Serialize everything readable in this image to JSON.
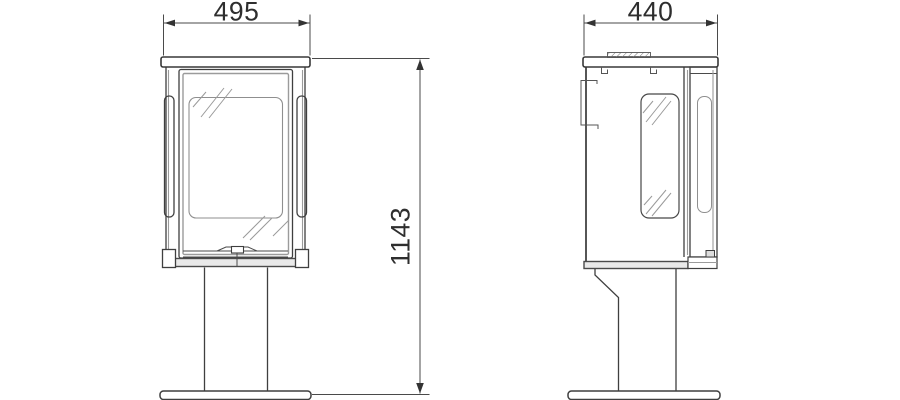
{
  "drawing": {
    "background": "#ffffff",
    "line_color": "#3f3f3f",
    "secondary_line_color": "#9b9b9b",
    "dimension_text_color": "#2e2e2e",
    "views": [
      {
        "id": "front-elevation"
      },
      {
        "id": "side-elevation"
      }
    ],
    "dimensions": {
      "front_width": "495",
      "side_depth": "440",
      "overall_height": "1143"
    }
  }
}
